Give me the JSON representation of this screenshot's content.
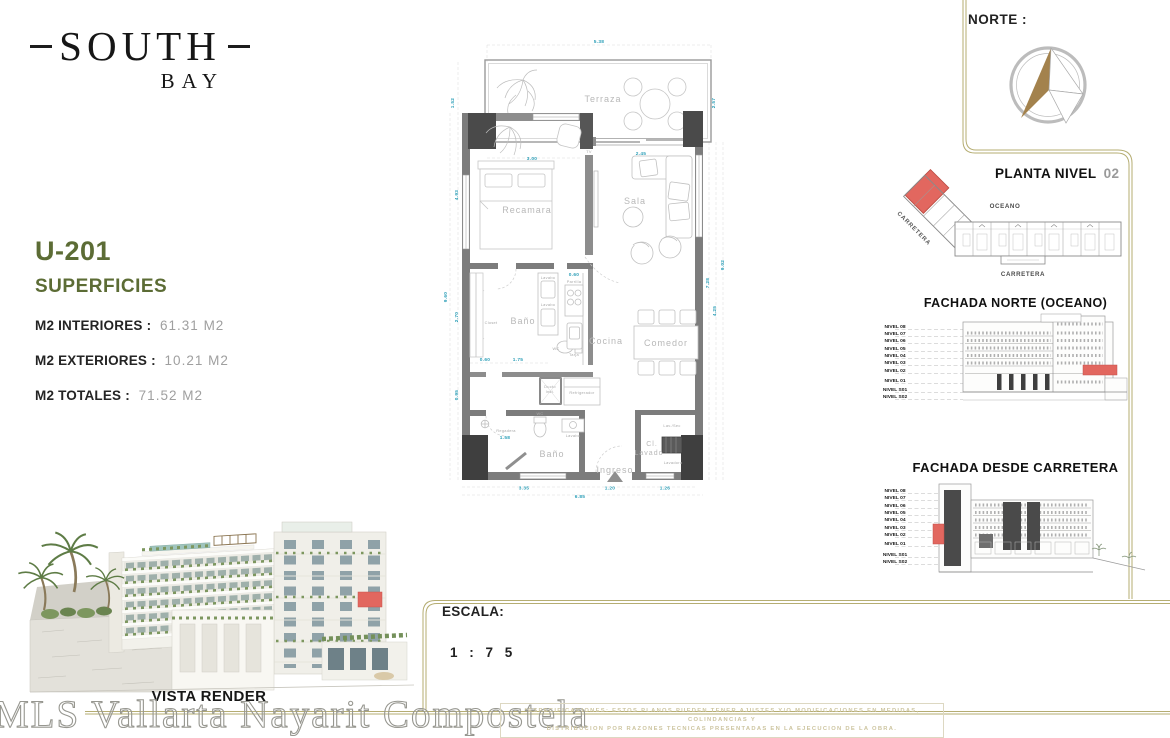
{
  "colors": {
    "accent_olive": "#5c6c35",
    "gold_border": "#b5ad72",
    "highlight_red": "#e2675f",
    "dim_teal": "#2d9fb8",
    "value_gray": "#9f9f9f"
  },
  "logo": {
    "name": "SOUTH",
    "sub": "BAY"
  },
  "unit": {
    "id": "U-201",
    "section_title": "SUPERFICIES",
    "metrics": [
      {
        "label": "M2 INTERIORES :",
        "value": "61.31  M2"
      },
      {
        "label": "M2 EXTERIORES :",
        "value": "10.21  M2"
      },
      {
        "label": "M2 TOTALES :",
        "value": "71.52  M2"
      }
    ]
  },
  "floorplan": {
    "rooms": {
      "terraza": "Terraza",
      "recamara": "Recamara",
      "sala": "Sala",
      "bano_upper": "Baño",
      "cocina": "Cocina",
      "comedor": "Comedor",
      "bano_lower": "Baño",
      "ingreso": "Ingreso",
      "cl_lavado_1": "Cl.",
      "cl_lavado_2": "Lavado"
    },
    "fixtures": {
      "tv": "TV",
      "closet": "Closet",
      "lavabo_a": "Lavabo",
      "lavabo_b": "Lavabo",
      "parrilla": "Parrilla",
      "tarja": "Tarja",
      "wc_a": "WC",
      "wc_b": "WC",
      "regadera": "Regadera",
      "ducto_1": "Ducto",
      "ducto_2": "Inst.",
      "refrigerador": "Refrigerador",
      "lavabo_c": "Lavabo",
      "lav_sec": "Lav./Sec",
      "lavadora": "Lavadora"
    },
    "dims": {
      "top_terraza": "5.38",
      "left_terraza": "1.52",
      "left_recamara": "4.93",
      "left_total": "9.60",
      "left_bano": "2.70",
      "left_lower": "0.95",
      "right_terraza": "2.57",
      "right_sala": "7.28",
      "right_mid": "4.25",
      "right_total": "9.02",
      "recamara_width": "3.00",
      "sala_window": "2.45",
      "parrilla_width": "0.60",
      "bano_door": "0.60",
      "bano_width": "1.75",
      "regadera_width": "1.58",
      "bottom_bano": "3.35",
      "bottom_ingreso": "1.20",
      "bottom_lavado": "1.26",
      "bottom_total": "6.85"
    }
  },
  "norte": {
    "label": "NORTE :"
  },
  "planta": {
    "title": "PLANTA NIVEL",
    "number": "02",
    "oceano": "OCEANO",
    "carretera_bottom": "CARRETERA",
    "carretera_diagonal": "CARRETERA"
  },
  "fachada_norte": {
    "title": "FACHADA NORTE (OCEANO)",
    "levels": [
      "NIVEL 08",
      "NIVEL 07",
      "NIVEL 06",
      "NIVEL 05",
      "NIVEL 04",
      "NIVEL 03",
      "NIVEL 02",
      "NIVEL 01",
      "NIVEL S01",
      "NIVEL S02"
    ]
  },
  "fachada_carretera": {
    "title": "FACHADA DESDE CARRETERA",
    "levels": [
      "NIVEL 08",
      "NIVEL 07",
      "NIVEL 06",
      "NIVEL 05",
      "NIVEL 04",
      "NIVEL 03",
      "NIVEL 02",
      "NIVEL 01",
      "NIVEL S01",
      "NIVEL S02"
    ]
  },
  "vista": {
    "label": "VISTA RENDER"
  },
  "escala": {
    "label": "ESCALA:",
    "value": "1 : 7 5"
  },
  "watermark": "MLS Vallarta Nayarit Compostela",
  "disclaimer": {
    "line1": "*ESPECIFICACIONES:  ESTOS PLANOS PUEDEN TENER AJUSTES Y/O MODIFICACIONES EN MEDIDAS, COLINDANCIAS Y",
    "line2": "DISTRIBUCION POR RAZONES TECNICAS PRESENTADAS EN LA EJECUCION DE LA OBRA."
  }
}
